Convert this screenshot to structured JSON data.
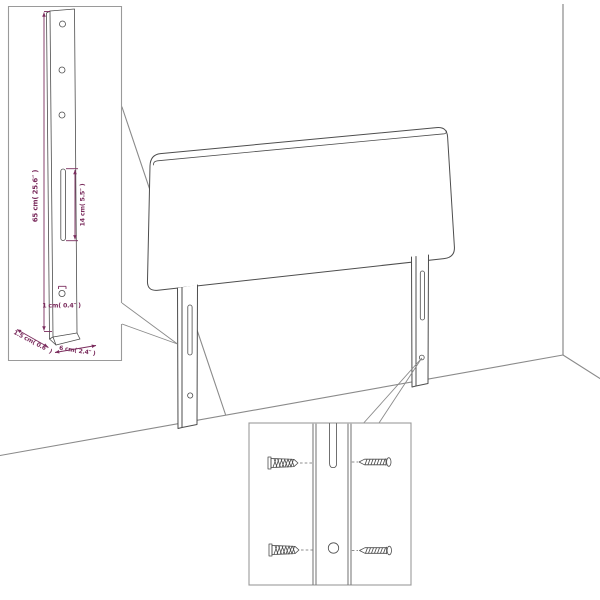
{
  "dimensions": {
    "height": "65 cm( 25.6″ )",
    "slot_height": "14 cm( 5.5″ )",
    "hole": "1 cm( 0.4″ )",
    "thickness": "1.5 cm( 0.6″ )",
    "leg_width": "6 cm( 2.4″ )"
  },
  "colors": {
    "dimension_accent": "#7b2d5e",
    "drawing_line": "#4d4d4d",
    "room_line": "#8a8a8a",
    "inset_border": "#9a9a9a",
    "background": "#ffffff"
  }
}
